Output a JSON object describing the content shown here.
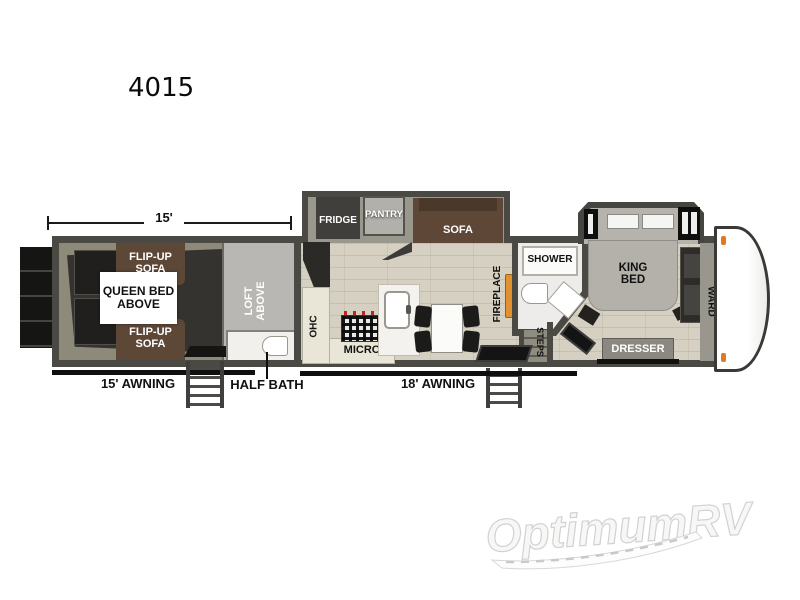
{
  "model": {
    "number": "4015"
  },
  "dimension": {
    "garage_length": "15'"
  },
  "awnings": {
    "garage": "15' AWNING",
    "main": "18' AWNING"
  },
  "garage": {
    "flip_up_sofa_top": "FLIP-UP\nSOFA",
    "flip_up_sofa_bottom": "FLIP-UP\nSOFA",
    "queen_bed": "QUEEN BED\nABOVE",
    "loft": "LOFT\nABOVE",
    "half_bath": "HALF BATH"
  },
  "kitchen": {
    "fridge": "FRIDGE",
    "pantry": "PANTRY",
    "sofa": "SOFA",
    "ohc": "OHC",
    "micro": "MICRO",
    "fireplace": "FIREPLACE"
  },
  "bath": {
    "shower": "SHOWER",
    "steps": "STEPS"
  },
  "bedroom": {
    "king_bed": "KING\nBED",
    "dresser": "DRESSER",
    "wardrobe": "WARD"
  },
  "watermark": {
    "brand": "OptimumRV"
  },
  "colors": {
    "wall": "#4a4944",
    "floor": "#d5d0c1",
    "sofa_brown": "#5e4737",
    "fireplace_orange": "#e2912f",
    "marker_orange": "#e07a1f"
  }
}
